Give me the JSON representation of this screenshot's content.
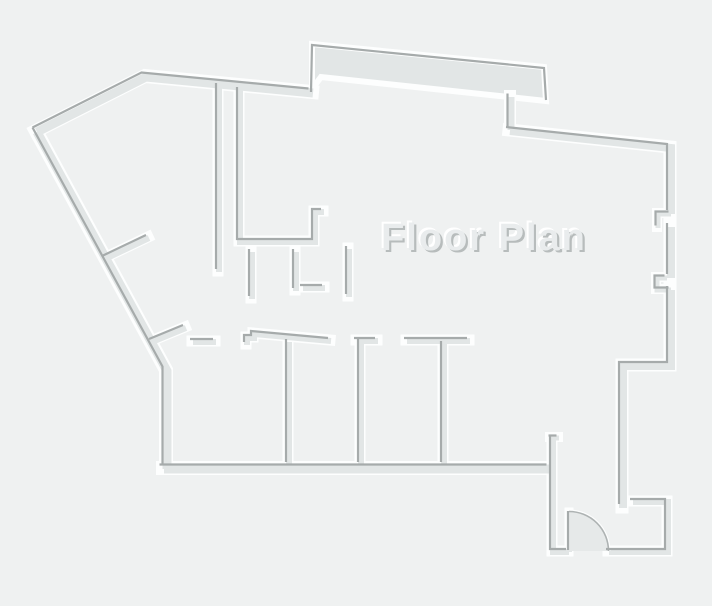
{
  "title": {
    "label": "Floor Plan"
  },
  "colors": {
    "background": "#eff1f1",
    "wall_fill": "#e2e6e6",
    "wall_edge_dark": "#a6abab",
    "wall_highlight": "#fdfefe",
    "door_fill": "#e6e9e9",
    "door_arc": "#aeb3b3",
    "title_fill": "#e9eced",
    "title_shadow_dark": "#b7bcbc",
    "title_shadow_light": "#ffffff"
  },
  "canvas": {
    "width": 712,
    "height": 606
  },
  "floor_plan": {
    "thick_band": {
      "polygon": [
        [
          312,
          44
        ],
        [
          544,
          67
        ],
        [
          546,
          101
        ],
        [
          509,
          97
        ],
        [
          321,
          77
        ],
        [
          312,
          89
        ]
      ],
      "dark_edge": [
        [
          311,
          92
        ],
        [
          312,
          45
        ],
        [
          544,
          68
        ],
        [
          546,
          100
        ]
      ]
    },
    "walls": [
      {
        "name": "exterior-top-wall",
        "points": [
          [
            36,
            131
          ],
          [
            145,
            76
          ],
          [
            312,
            92
          ]
        ],
        "w": 9
      },
      {
        "name": "exterior-left-wall",
        "points": [
          [
            36,
            131
          ],
          [
            166,
            370
          ],
          [
            166,
            468
          ]
        ],
        "w": 9
      },
      {
        "name": "exterior-bottom-wall",
        "points": [
          [
            163,
            468
          ],
          [
            550,
            468
          ]
        ],
        "w": 9
      },
      {
        "name": "top-connector-wall",
        "points": [
          [
            510,
            96
          ],
          [
            510,
            129
          ]
        ],
        "w": 7
      },
      {
        "name": "right-upper-wall",
        "points": [
          [
            509,
            130
          ],
          [
            670,
            147
          ],
          [
            670,
            213
          ]
        ],
        "w": 8
      },
      {
        "name": "right-window-upper",
        "points": [
          [
            670,
            213
          ],
          [
            657,
            213
          ],
          [
            657,
            227
          ]
        ],
        "w": 5
      },
      {
        "name": "right-mid-wall",
        "points": [
          [
            670,
            226
          ],
          [
            670,
            277
          ]
        ],
        "w": 8
      },
      {
        "name": "right-window-lower",
        "points": [
          [
            666,
            277
          ],
          [
            656,
            277
          ],
          [
            656,
            289
          ],
          [
            670,
            289
          ]
        ],
        "w": 5
      },
      {
        "name": "right-lower-wall",
        "points": [
          [
            670,
            289
          ],
          [
            670,
            365
          ],
          [
            622,
            365
          ],
          [
            622,
            507
          ]
        ],
        "w": 8
      },
      {
        "name": "hall-left-wall",
        "points": [
          [
            218,
            85
          ],
          [
            218,
            271
          ]
        ],
        "w": 6
      },
      {
        "name": "closet-wall",
        "points": [
          [
            239,
            89
          ],
          [
            239,
            241
          ],
          [
            314,
            241
          ],
          [
            314,
            211
          ],
          [
            323,
            211
          ]
        ],
        "w": 6
      },
      {
        "name": "stall-wall-1",
        "points": [
          [
            251,
            251
          ],
          [
            251,
            298
          ]
        ],
        "w": 6
      },
      {
        "name": "stall-wall-2",
        "points": [
          [
            295,
            251
          ],
          [
            295,
            290
          ]
        ],
        "w": 6
      },
      {
        "name": "stall-tick",
        "points": [
          [
            302,
            287
          ],
          [
            324,
            287
          ]
        ],
        "w": 6
      },
      {
        "name": "stall-wall-3",
        "points": [
          [
            348,
            248
          ],
          [
            348,
            296
          ]
        ],
        "w": 6
      },
      {
        "name": "diagonal-stub-upper",
        "points": [
          [
            104,
            258
          ],
          [
            148,
            237
          ]
        ],
        "w": 6
      },
      {
        "name": "diagonal-stub-lower",
        "points": [
          [
            151,
            341
          ],
          [
            185,
            327
          ]
        ],
        "w": 6
      },
      {
        "name": "doorway-tick-left",
        "points": [
          [
            192,
            341
          ],
          [
            215,
            341
          ]
        ],
        "w": 6
      },
      {
        "name": "middle-wall",
        "points": [
          [
            246,
            344
          ],
          [
            246,
            337
          ],
          [
            253,
            337
          ],
          [
            253,
            333
          ],
          [
            330,
            340
          ]
        ],
        "w": 6
      },
      {
        "name": "room-divider-1",
        "points": [
          [
            288,
            341
          ],
          [
            288,
            464
          ]
        ],
        "w": 6
      },
      {
        "name": "room-divider-2-tick",
        "points": [
          [
            356,
            340
          ],
          [
            377,
            340
          ]
        ],
        "w": 6
      },
      {
        "name": "room-divider-2",
        "points": [
          [
            360,
            341
          ],
          [
            360,
            464
          ]
        ],
        "w": 6
      },
      {
        "name": "room-divider-3-bar",
        "points": [
          [
            406,
            340
          ],
          [
            469,
            340
          ]
        ],
        "w": 6
      },
      {
        "name": "room-divider-3",
        "points": [
          [
            443,
            343
          ],
          [
            443,
            464
          ]
        ],
        "w": 6
      },
      {
        "name": "corridor-stub-tick",
        "points": [
          [
            550,
            437
          ],
          [
            558,
            437
          ]
        ],
        "w": 5
      },
      {
        "name": "corridor-wall",
        "points": [
          [
            552,
            438
          ],
          [
            552,
            551
          ],
          [
            568,
            551
          ]
        ],
        "w": 6
      },
      {
        "name": "entry-wall",
        "points": [
          [
            632,
            501
          ],
          [
            667,
            501
          ],
          [
            667,
            551
          ],
          [
            608,
            551
          ]
        ],
        "w": 6
      },
      {
        "name": "door-leaf",
        "points": [
          [
            569,
            551
          ],
          [
            569,
            512
          ]
        ],
        "w": 4
      }
    ],
    "door": {
      "hinge": [
        569,
        551
      ],
      "radius": 39.5,
      "leaf_tip": [
        569,
        511.5
      ],
      "arc_end": [
        608.5,
        551
      ]
    },
    "title_pos": {
      "x": 484,
      "y": 250
    }
  }
}
